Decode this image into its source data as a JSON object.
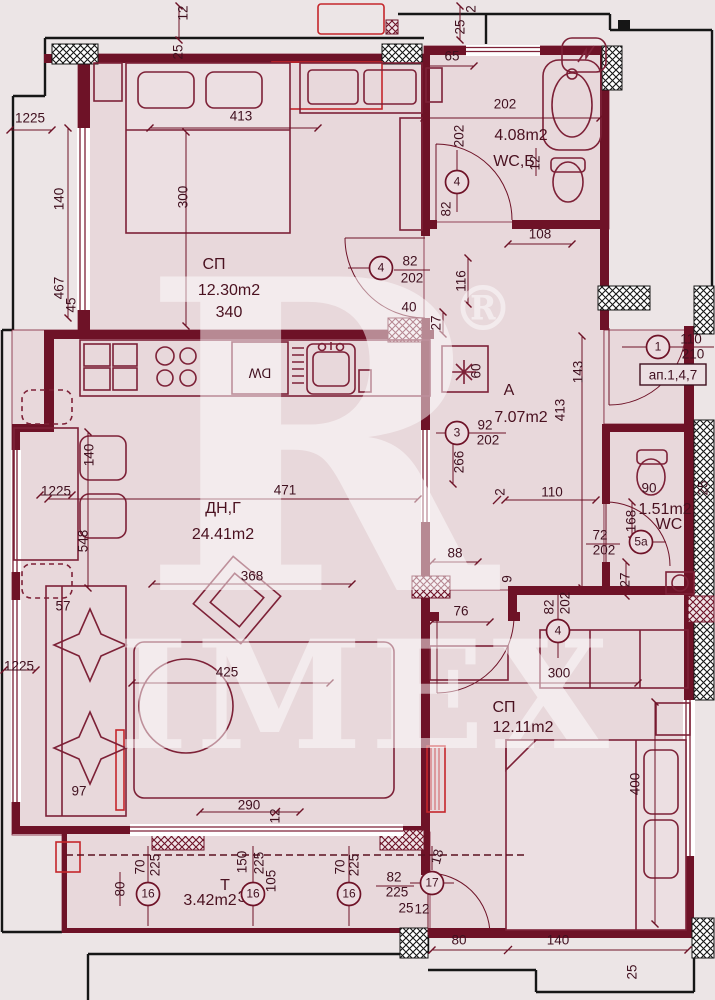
{
  "watermark": {
    "letter": "R",
    "registered": "®",
    "word": "IMEX"
  },
  "apartment_ref": "ап.1,4,7",
  "colors": {
    "wall": "#6e1227",
    "line": "#7d2137",
    "room_fill": "#e8d8db",
    "background": "#ece5e6",
    "accent_red": "#c5262b",
    "black": "#161616"
  },
  "rooms": [
    {
      "name": "СП",
      "area": "12.30m2",
      "note": "340"
    },
    {
      "name": "WC,Б",
      "area": "4.08m2",
      "note": "202"
    },
    {
      "name": "A",
      "area": "7.07m2"
    },
    {
      "name": "ДН,Г",
      "area": "24.41m2"
    },
    {
      "name": "WC",
      "area": "1.51m2"
    },
    {
      "name": "СП",
      "area": "12.11m2"
    },
    {
      "name": "T",
      "area": "3.42m2",
      "note": "323"
    }
  ],
  "labels": [
    {
      "t": "СП",
      "x": 214,
      "y": 265,
      "c": "room",
      "n": "room-label-bedroom1"
    },
    {
      "t": "12.30m2",
      "x": 229,
      "y": 291,
      "c": "room",
      "n": "room-area-bedroom1"
    },
    {
      "t": "340",
      "x": 229,
      "y": 313,
      "c": "room",
      "n": "room-note-bedroom1"
    },
    {
      "t": "4.08m2",
      "x": 521,
      "y": 136,
      "c": "room",
      "n": "room-area-bath"
    },
    {
      "t": "WC,Б",
      "x": 514,
      "y": 162,
      "c": "room",
      "n": "room-label-bath"
    },
    {
      "t": "A",
      "x": 509,
      "y": 391,
      "c": "room",
      "n": "room-label-hall"
    },
    {
      "t": "7.07m2",
      "x": 521,
      "y": 418,
      "c": "room",
      "n": "room-area-hall"
    },
    {
      "t": "ДН,Г",
      "x": 223,
      "y": 509,
      "c": "room",
      "n": "room-label-living"
    },
    {
      "t": "24.41m2",
      "x": 223,
      "y": 535,
      "c": "room",
      "n": "room-area-living"
    },
    {
      "t": "1.51m2",
      "x": 665,
      "y": 510,
      "s": 14,
      "c": "room",
      "n": "room-area-wc"
    },
    {
      "t": "WC",
      "x": 669,
      "y": 525,
      "s": 14,
      "c": "room",
      "n": "room-label-wc"
    },
    {
      "t": "СП",
      "x": 504,
      "y": 708,
      "c": "room",
      "n": "room-label-bedroom2"
    },
    {
      "t": "12.11m2",
      "x": 523,
      "y": 728,
      "c": "room",
      "n": "room-area-bedroom2"
    },
    {
      "t": "T",
      "x": 225,
      "y": 886,
      "s": 14,
      "c": "room",
      "n": "room-label-terrace"
    },
    {
      "t": "3.42m2",
      "x": 210,
      "y": 901,
      "s": 14,
      "c": "room",
      "n": "room-area-terrace"
    },
    {
      "t": "323",
      "x": 251,
      "y": 898,
      "s": 14,
      "c": "room",
      "n": "room-note-terrace"
    },
    {
      "t": "413",
      "x": 241,
      "y": 117
    },
    {
      "t": "300",
      "x": 184,
      "y": 197,
      "r": -90
    },
    {
      "t": "140",
      "x": 60,
      "y": 199,
      "r": -90
    },
    {
      "t": "467",
      "x": 60,
      "y": 288,
      "r": -90
    },
    {
      "t": "45",
      "x": 72,
      "y": 305,
      "r": -90
    },
    {
      "t": "1225",
      "x": 30,
      "y": 119,
      "s": 12
    },
    {
      "t": "12",
      "x": 184,
      "y": 13,
      "r": -90,
      "s": 12
    },
    {
      "t": "25",
      "x": 179,
      "y": 52,
      "r": -90,
      "s": 12
    },
    {
      "t": "2",
      "x": 472,
      "y": 9,
      "r": -90,
      "s": 12
    },
    {
      "t": "25",
      "x": 461,
      "y": 27,
      "r": -90,
      "s": 12
    },
    {
      "t": "65",
      "x": 452,
      "y": 57
    },
    {
      "t": "202",
      "x": 505,
      "y": 105
    },
    {
      "t": "202",
      "x": 460,
      "y": 136,
      "r": -90
    },
    {
      "t": "82",
      "x": 447,
      "y": 209,
      "r": -90
    },
    {
      "t": "12",
      "x": 536,
      "y": 163,
      "r": -90,
      "s": 12
    },
    {
      "t": "108",
      "x": 540,
      "y": 235
    },
    {
      "t": "82",
      "x": 410,
      "y": 262
    },
    {
      "t": "202",
      "x": 412,
      "y": 279
    },
    {
      "t": "116",
      "x": 462,
      "y": 281,
      "r": -90
    },
    {
      "t": "40",
      "x": 409,
      "y": 308
    },
    {
      "t": "27",
      "x": 437,
      "y": 323,
      "r": -90
    },
    {
      "t": "60",
      "x": 477,
      "y": 371,
      "r": -90
    },
    {
      "t": "143",
      "x": 579,
      "y": 372,
      "r": -90
    },
    {
      "t": "413",
      "x": 561,
      "y": 410,
      "r": -90
    },
    {
      "t": "110",
      "x": 691,
      "y": 340
    },
    {
      "t": "210",
      "x": 693,
      "y": 355
    },
    {
      "t": "92",
      "x": 485,
      "y": 426
    },
    {
      "t": "202",
      "x": 488,
      "y": 441
    },
    {
      "t": "266",
      "x": 460,
      "y": 462,
      "r": -90
    },
    {
      "t": "110",
      "x": 552,
      "y": 493
    },
    {
      "t": "2",
      "x": 501,
      "y": 492,
      "r": -90,
      "s": 12
    },
    {
      "t": "471",
      "x": 285,
      "y": 491
    },
    {
      "t": "368",
      "x": 252,
      "y": 577
    },
    {
      "t": "548",
      "x": 84,
      "y": 541,
      "r": -90
    },
    {
      "t": "140",
      "x": 90,
      "y": 455,
      "r": -90
    },
    {
      "t": "1225",
      "x": 56,
      "y": 492,
      "s": 12
    },
    {
      "t": "57",
      "x": 63,
      "y": 607,
      "s": 12
    },
    {
      "t": "1225",
      "x": 19,
      "y": 667,
      "s": 12
    },
    {
      "t": "97",
      "x": 79,
      "y": 792,
      "s": 12
    },
    {
      "t": "88",
      "x": 455,
      "y": 554
    },
    {
      "t": "76",
      "x": 461,
      "y": 612
    },
    {
      "t": "9",
      "x": 508,
      "y": 579,
      "r": -90,
      "s": 12
    },
    {
      "t": "82",
      "x": 550,
      "y": 607,
      "r": -90
    },
    {
      "t": "202",
      "x": 566,
      "y": 603,
      "r": -90
    },
    {
      "t": "300",
      "x": 559,
      "y": 674
    },
    {
      "t": "425",
      "x": 227,
      "y": 673
    },
    {
      "t": "90",
      "x": 649,
      "y": 489,
      "s": 12
    },
    {
      "t": "168",
      "x": 632,
      "y": 521,
      "r": -90
    },
    {
      "t": "72",
      "x": 600,
      "y": 536
    },
    {
      "t": "202",
      "x": 604,
      "y": 551
    },
    {
      "t": "27",
      "x": 626,
      "y": 580,
      "r": -90
    },
    {
      "t": "25",
      "x": 704,
      "y": 488,
      "r": -90,
      "s": 12
    },
    {
      "t": "400",
      "x": 636,
      "y": 784,
      "r": -90
    },
    {
      "t": "290",
      "x": 249,
      "y": 806
    },
    {
      "t": "12",
      "x": 276,
      "y": 816,
      "r": -90,
      "s": 12
    },
    {
      "t": "80",
      "x": 121,
      "y": 889,
      "r": -90,
      "s": 12
    },
    {
      "t": "70",
      "x": 141,
      "y": 867,
      "r": -90,
      "s": 12
    },
    {
      "t": "225",
      "x": 156,
      "y": 865,
      "r": -90,
      "s": 12
    },
    {
      "t": "150",
      "x": 243,
      "y": 862,
      "r": -90,
      "s": 12
    },
    {
      "t": "225",
      "x": 260,
      "y": 863,
      "r": -90,
      "s": 12
    },
    {
      "t": "105",
      "x": 272,
      "y": 881,
      "r": -90,
      "s": 12
    },
    {
      "t": "70",
      "x": 341,
      "y": 867,
      "r": -90,
      "s": 12
    },
    {
      "t": "225",
      "x": 355,
      "y": 865,
      "r": -90,
      "s": 12
    },
    {
      "t": "18",
      "x": 438,
      "y": 857,
      "r": -75,
      "s": 12
    },
    {
      "t": "82",
      "x": 394,
      "y": 878
    },
    {
      "t": "225",
      "x": 397,
      "y": 893
    },
    {
      "t": "25",
      "x": 406,
      "y": 909,
      "s": 12
    },
    {
      "t": "12",
      "x": 422,
      "y": 910,
      "s": 12
    },
    {
      "t": "80",
      "x": 459,
      "y": 941
    },
    {
      "t": "140",
      "x": 558,
      "y": 941
    },
    {
      "t": "25",
      "x": 633,
      "y": 972,
      "r": -90,
      "s": 12
    },
    {
      "t": "DW",
      "x": 260,
      "y": 372,
      "r": 180,
      "s": 14,
      "n": "dishwasher-label"
    }
  ],
  "door_markers": [
    {
      "n": "4",
      "x": 381,
      "y": 268
    },
    {
      "n": "4",
      "x": 457,
      "y": 182
    },
    {
      "n": "3",
      "x": 457,
      "y": 433
    },
    {
      "n": "1",
      "x": 658,
      "y": 347
    },
    {
      "n": "5a",
      "x": 641,
      "y": 542
    },
    {
      "n": "4",
      "x": 558,
      "y": 631
    },
    {
      "n": "16",
      "x": 148,
      "y": 894
    },
    {
      "n": "16",
      "x": 253,
      "y": 894
    },
    {
      "n": "16",
      "x": 349,
      "y": 894
    },
    {
      "n": "17",
      "x": 432,
      "y": 883
    }
  ]
}
